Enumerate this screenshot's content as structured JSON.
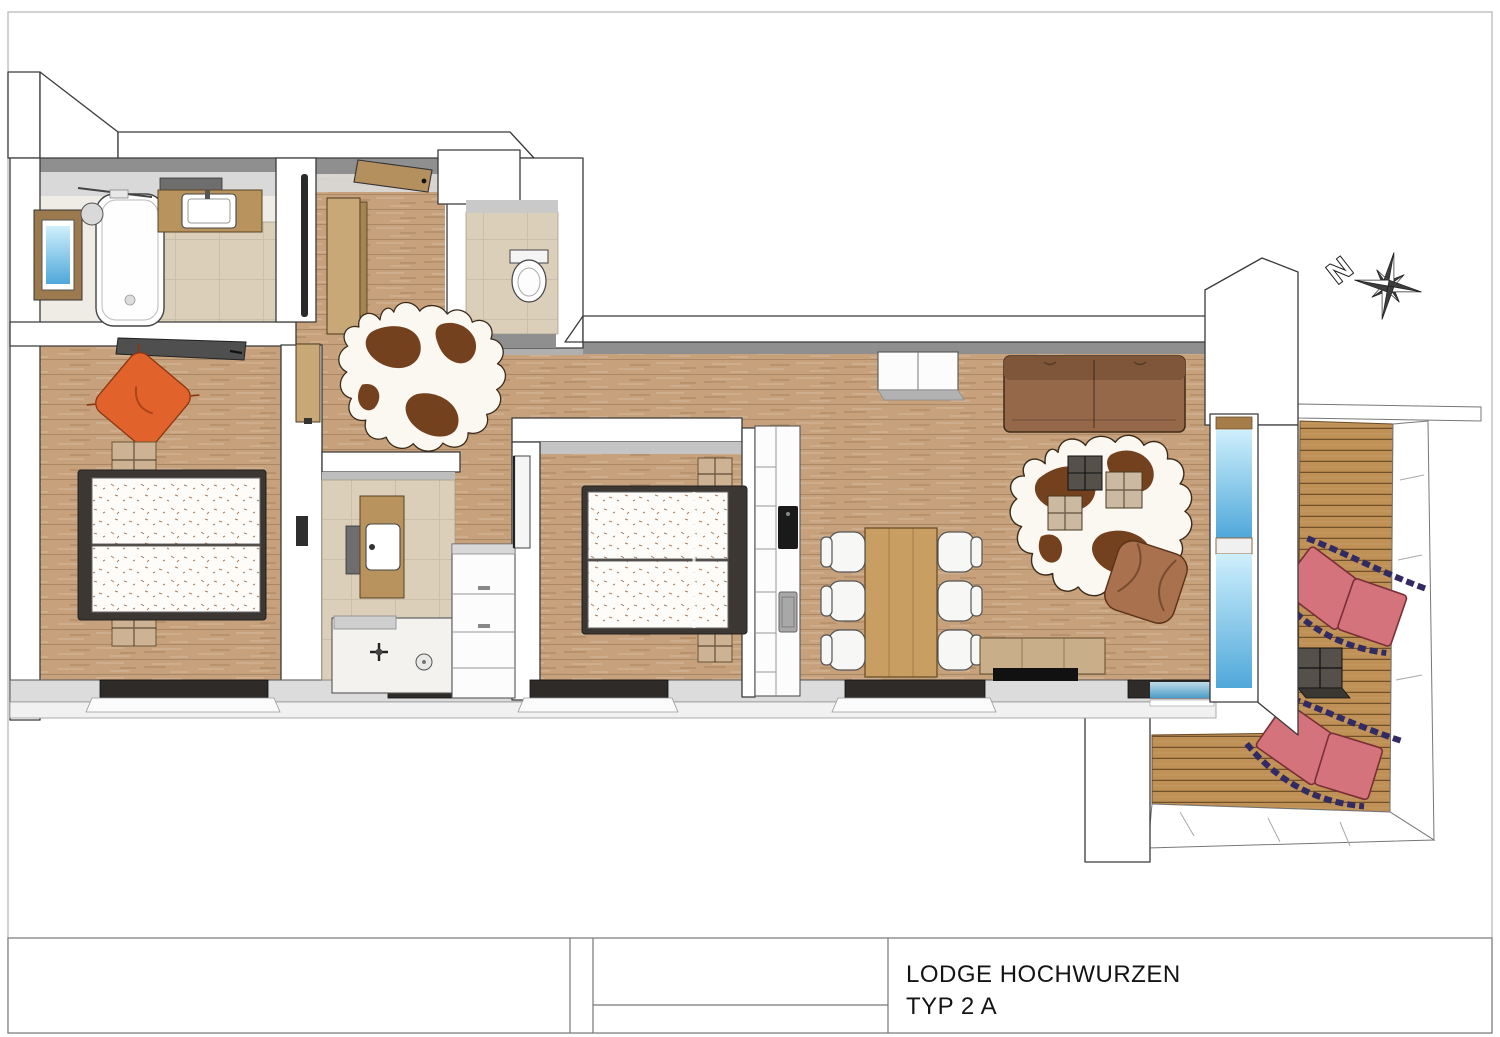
{
  "title_block": {
    "project": "LODGE HOCHWURZEN",
    "unit": "TYP  2 A"
  },
  "compass": {
    "north_label": "N"
  },
  "rooms": [
    "bathroom",
    "hallway",
    "wc",
    "bedroom-1",
    "ensuite-bathroom",
    "bedroom-2",
    "kitchen-dining",
    "living-room",
    "balcony"
  ],
  "furniture": [
    "bathtub",
    "washbasin",
    "mirror",
    "toilet",
    "entrance-door",
    "hall-wardrobe",
    "cowhide-rug",
    "double-bed",
    "nightstand",
    "beanbag-cushion",
    "sliding-wardrobe",
    "vanity-sink",
    "shower",
    "dresser",
    "kitchenette",
    "cooktop",
    "kitchen-sink",
    "dining-table",
    "dining-chair",
    "sofa",
    "coffee-cube-table",
    "pouf",
    "tv-sideboard",
    "sun-lounger",
    "balcony-side-table",
    "compass-rose"
  ],
  "colors": {
    "wall": "#ffffff",
    "wall_line": "#3a3a3a",
    "wall_shadow": "#8f8f8f",
    "ceiling": "#d9d9d9",
    "bottom_wall_top": "#dcdcdc",
    "bottom_wall_face": "#f1f1f1",
    "wood_floor": "#c7a17c",
    "tile_floor": "#dbcfba",
    "bath_floor": "#efece6",
    "deck": "#bf9156",
    "glass_light": "#cfeffc",
    "glass_dark": "#4fa8da",
    "sofa": "#96684a",
    "sofa_back": "#7f5639",
    "pouf": "#a9714e",
    "table_wood": "#c99e63",
    "chair": "#f7f7f5",
    "lounger": "#d4737c",
    "lounger_frame": "#322a63",
    "beanbag": "#e2622b",
    "cowhide": "#74411f",
    "mattress": "#fdfcf8",
    "bed_frame": "#3c3733",
    "nightstand": "#cdb293",
    "cooktop": "#1a1a1a",
    "sink_steel": "#a8a8a8",
    "sideboard": "#c9ae8a",
    "tv_panel": "#111111",
    "cube_dark": "#55514a",
    "cube_beige": "#cbb9a2",
    "vanity_wood": "#b8935e",
    "cabinet_wood": "#c8a877",
    "door_wood": "#b5905f",
    "wardrobe_slab": "#4f4f4f"
  }
}
